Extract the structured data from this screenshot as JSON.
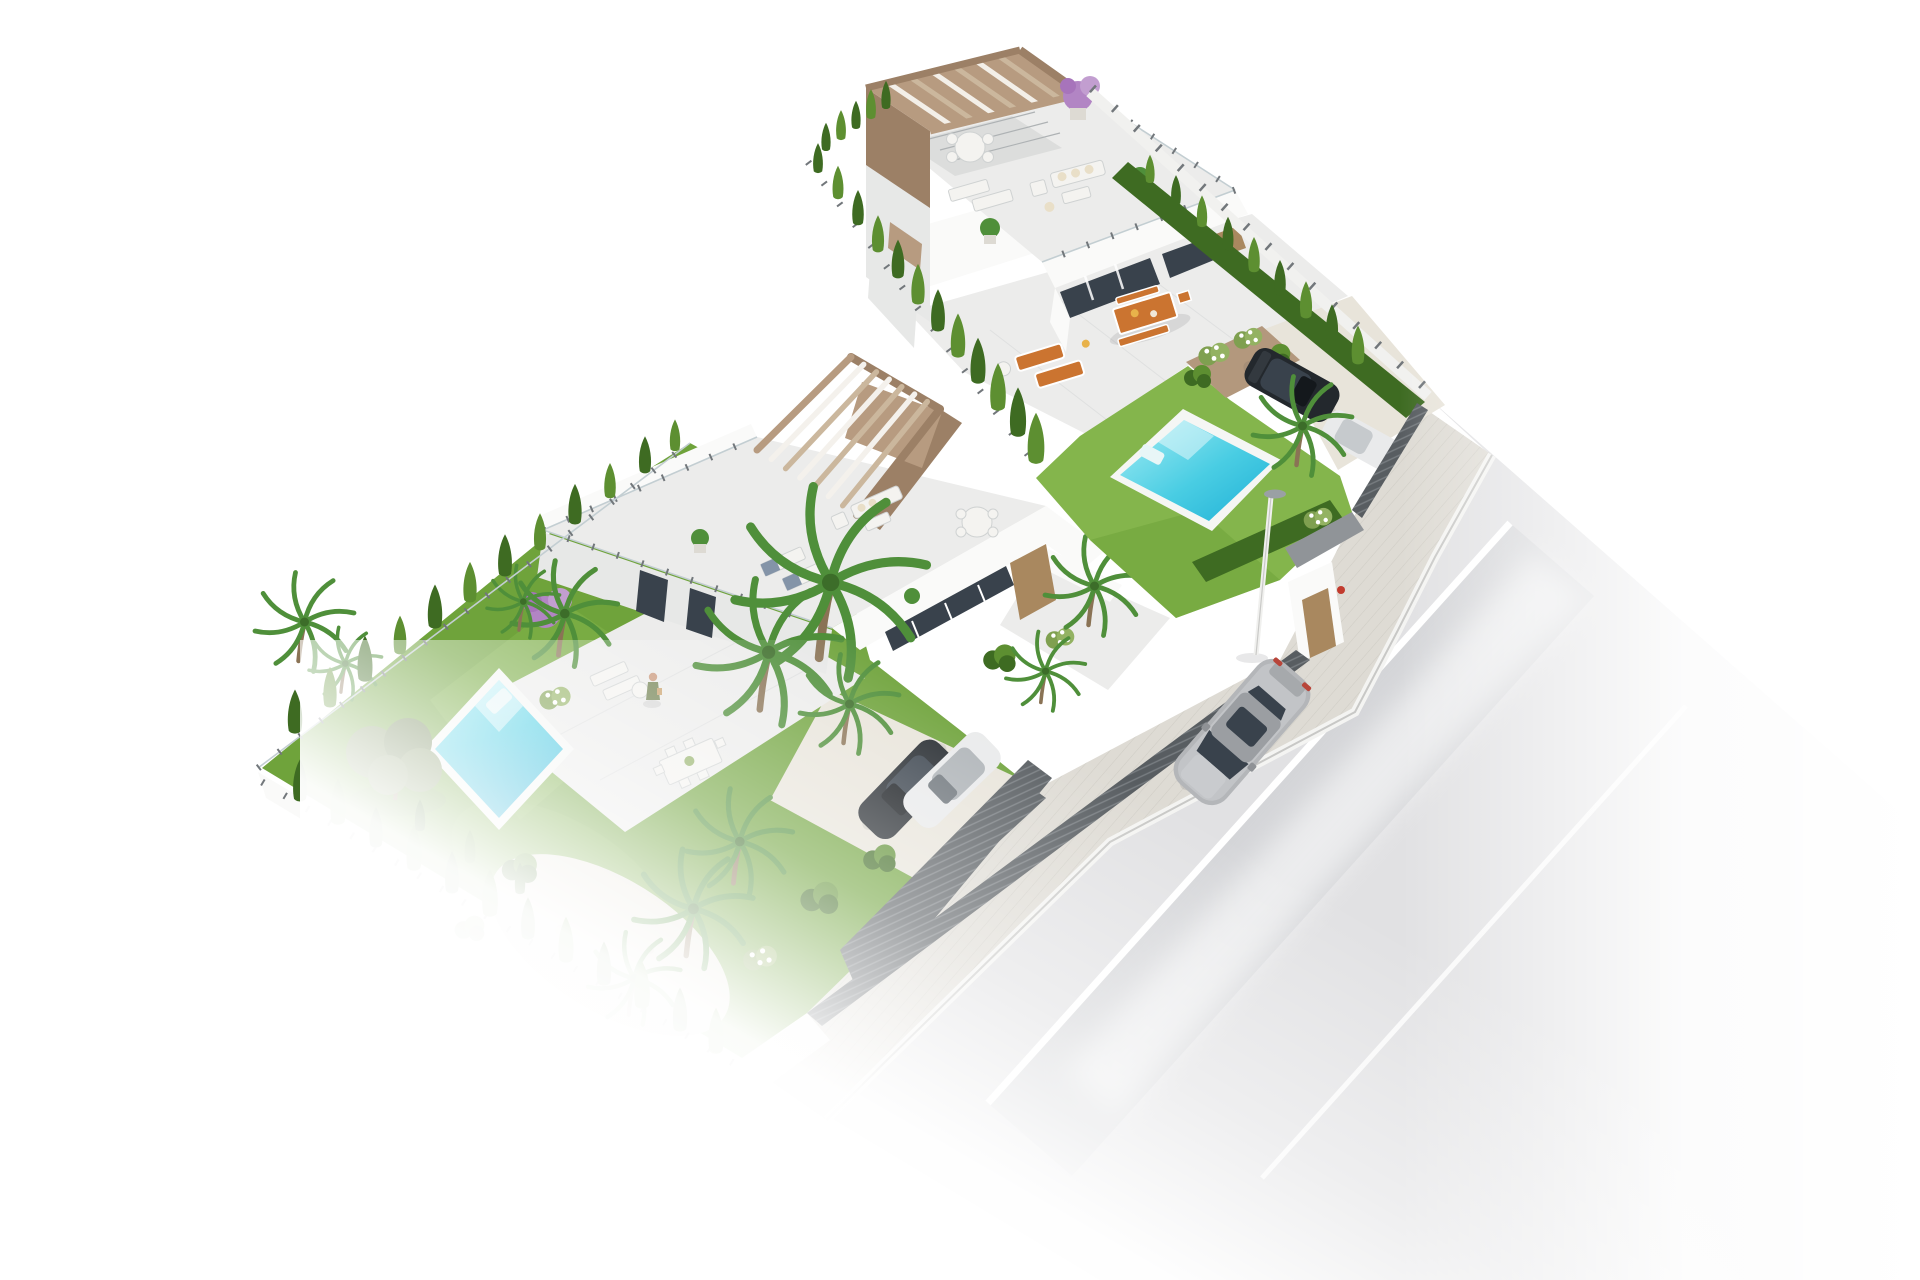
{
  "title": "aerial-3d-render-two-modern-villas-with-pools",
  "scene": {
    "type": "architectural-3d-visualization",
    "view": "isometric-aerial",
    "background": "white",
    "counts": {
      "villas": 2,
      "swimming_pools": 2,
      "parked_cars": 3,
      "driving_cars": 1,
      "street_lamps": 1,
      "pedestrians": 1
    },
    "objects": [
      "upper-villa",
      "lower-villa",
      "upper-rooftop-pergola",
      "lower-rooftop-pergola",
      "upper-rooftop-terrace",
      "lower-rooftop-terrace",
      "upper-pool",
      "lower-pool",
      "upper-lawn",
      "lower-lawn",
      "cypress-hedgerows",
      "palm-trees",
      "olive-tree",
      "bougainvillea",
      "orange-dining-set",
      "orange-sun-loungers",
      "white-lounge-furniture",
      "privacy-fence",
      "glass-fence",
      "pedestrian-gate",
      "driveway",
      "parked-dark-car",
      "parked-white-car",
      "street-lamp",
      "silver-car-on-road",
      "sidewalk",
      "road-with-lane-line",
      "person-on-terrace",
      "garden-shrubs",
      "gravel-path"
    ]
  },
  "colors": {
    "bg": "#ffffff",
    "lawn": "#6fa33b",
    "lawn_light": "#84b54c",
    "hedge": "#3e6b22",
    "hedge_light": "#5d8f31",
    "palm": "#4f8f3a",
    "trunk": "#8a7355",
    "olive": "#7d915f",
    "purple": "#b285c4",
    "pool_deep": "#1fb0d6",
    "pool_mid": "#49cde3",
    "pool_light": "#a3ecf4",
    "pool_rim": "#f5f6f4",
    "terrace": "#ececeb",
    "terrace_shadow": "#dcdddc",
    "wall_white": "#fafaf9",
    "wall_shade": "#e7e8e7",
    "pergola": "#b79b80",
    "pergola_dark": "#9c8066",
    "pergola_light": "#cbb79d",
    "road": "#e1e1e3",
    "road_dark": "#cfd0d4",
    "sidewalk": "#dedbd4",
    "sidewalk_line": "#c9c6be",
    "curb": "#f1f1ef",
    "fence_dark": "#585d61",
    "fence_mid": "#72777b",
    "glass": "#c3ced2",
    "car_dark": "#23282d",
    "car_silver": "#b4b6b9",
    "car_white": "#e9eaeb",
    "car_glass": "#39424c",
    "orange": "#cb7430",
    "towel": "#8494a8",
    "gravel": "#e8e4da",
    "planter": "#b3987d",
    "gate": "#909498",
    "door_wood": "#a9885f",
    "person_skin": "#c89577",
    "person_dress": "#6f7f4e",
    "lamp_head": "#9aa0a4"
  }
}
